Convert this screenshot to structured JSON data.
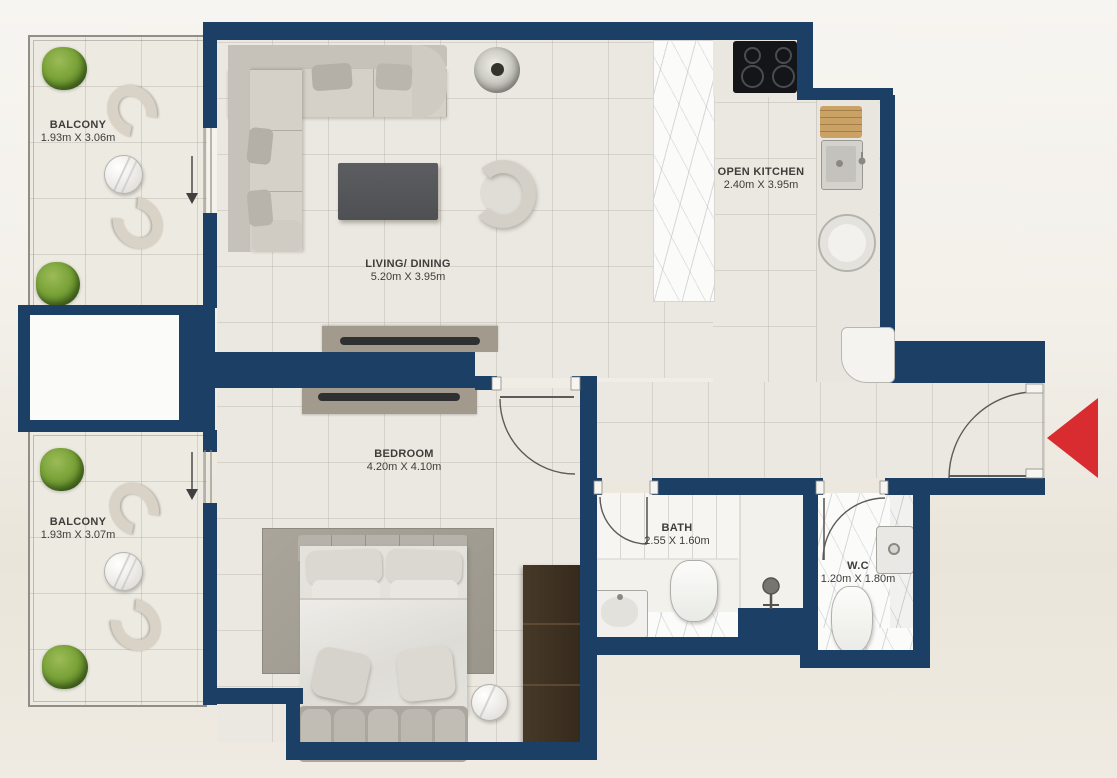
{
  "floorplan": {
    "rooms": {
      "balcony_top": {
        "name": "BALCONY",
        "dims": "1.93m X 3.06m"
      },
      "living_dining": {
        "name": "LIVING/ DINING",
        "dims": "5.20m X 3.95m"
      },
      "open_kitchen": {
        "name": "OPEN KITCHEN",
        "dims": "2.40m X 3.95m"
      },
      "bedroom": {
        "name": "BEDROOM",
        "dims": "4.20m X 4.10m"
      },
      "bath": {
        "name": "BATH",
        "dims": "2.55 X 1.60m"
      },
      "wc": {
        "name": "W.C",
        "dims": "1.20m X 1.80m"
      },
      "balcony_bottom": {
        "name": "BALCONY",
        "dims": "1.93m X 3.07m"
      }
    },
    "colors": {
      "wall_navy": "#1c4065",
      "entry_arrow_red": "#d92c31",
      "floor_beige": "#ebe8e1",
      "wardrobe_brown": "#3c2f23",
      "label_text": "#3f3d3a"
    },
    "icons": {
      "entry_arrow_icon": "solid red triangle pointing left at entrance door",
      "balcony_door_arrow_icon": "thin down arrow marking balcony sliding doors"
    }
  }
}
